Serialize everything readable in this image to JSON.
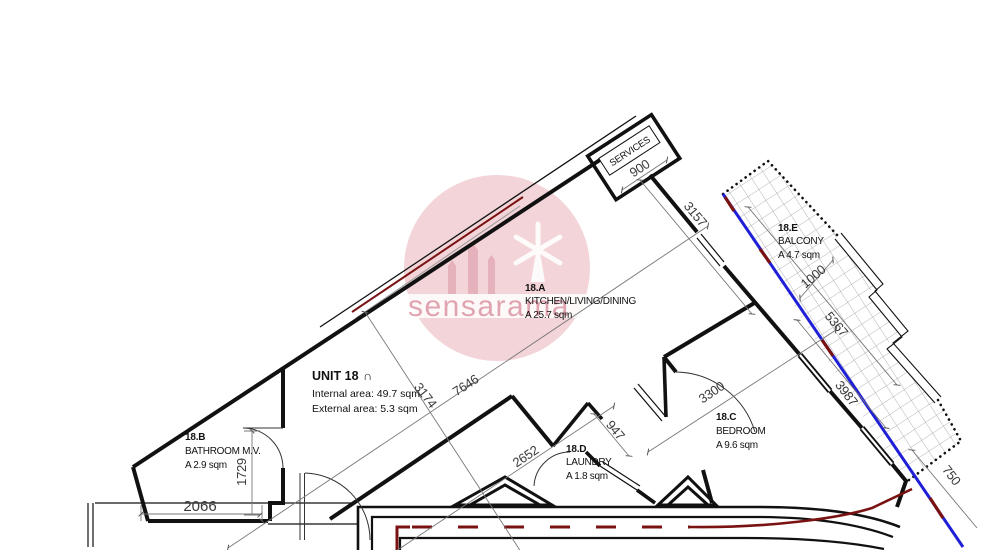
{
  "unit": {
    "title": "UNIT 18",
    "title_symbol": "∩",
    "internal_area": "Internal area: 49.7 sqm",
    "external_area": "External area: 5.3 sqm"
  },
  "rooms": [
    {
      "id": "18.A",
      "name": "KITCHEN/LIVING/DINING",
      "area": "A 25.7 sqm"
    },
    {
      "id": "18.B",
      "name": "BATHROOM M.V.",
      "area": "A 2.9 sqm"
    },
    {
      "id": "18.C",
      "name": "BEDROOM",
      "area": "A 9.6 sqm"
    },
    {
      "id": "18.D",
      "name": "LAUNDRY",
      "area": "A 1.8 sqm"
    },
    {
      "id": "18.E",
      "name": "BALCONY",
      "area": "A 4.7 sqm"
    }
  ],
  "labels": {
    "services": "SERVICES"
  },
  "dimensions": {
    "services_width": "900",
    "kitchen_side_wall": "3157",
    "balcony_width": "1000",
    "balcony_length": "5367",
    "bedroom_ext_wall": "3987",
    "boundary_offset": "750",
    "bedroom_width": "3300",
    "laundry_width": "947",
    "hall_wall": "2652",
    "kitchen_length": "7646",
    "kitchen_depth": "3174",
    "bathroom_width": "2066",
    "bathroom_length": "1729"
  },
  "watermark": {
    "text": "sensarama"
  },
  "colors": {
    "wall": "#111111",
    "boundary_blue": "#1f1fd8",
    "window_red": "#7a1212",
    "watermark_pink": "#e8aab2",
    "hatch_gray": "#a0a0a0"
  }
}
